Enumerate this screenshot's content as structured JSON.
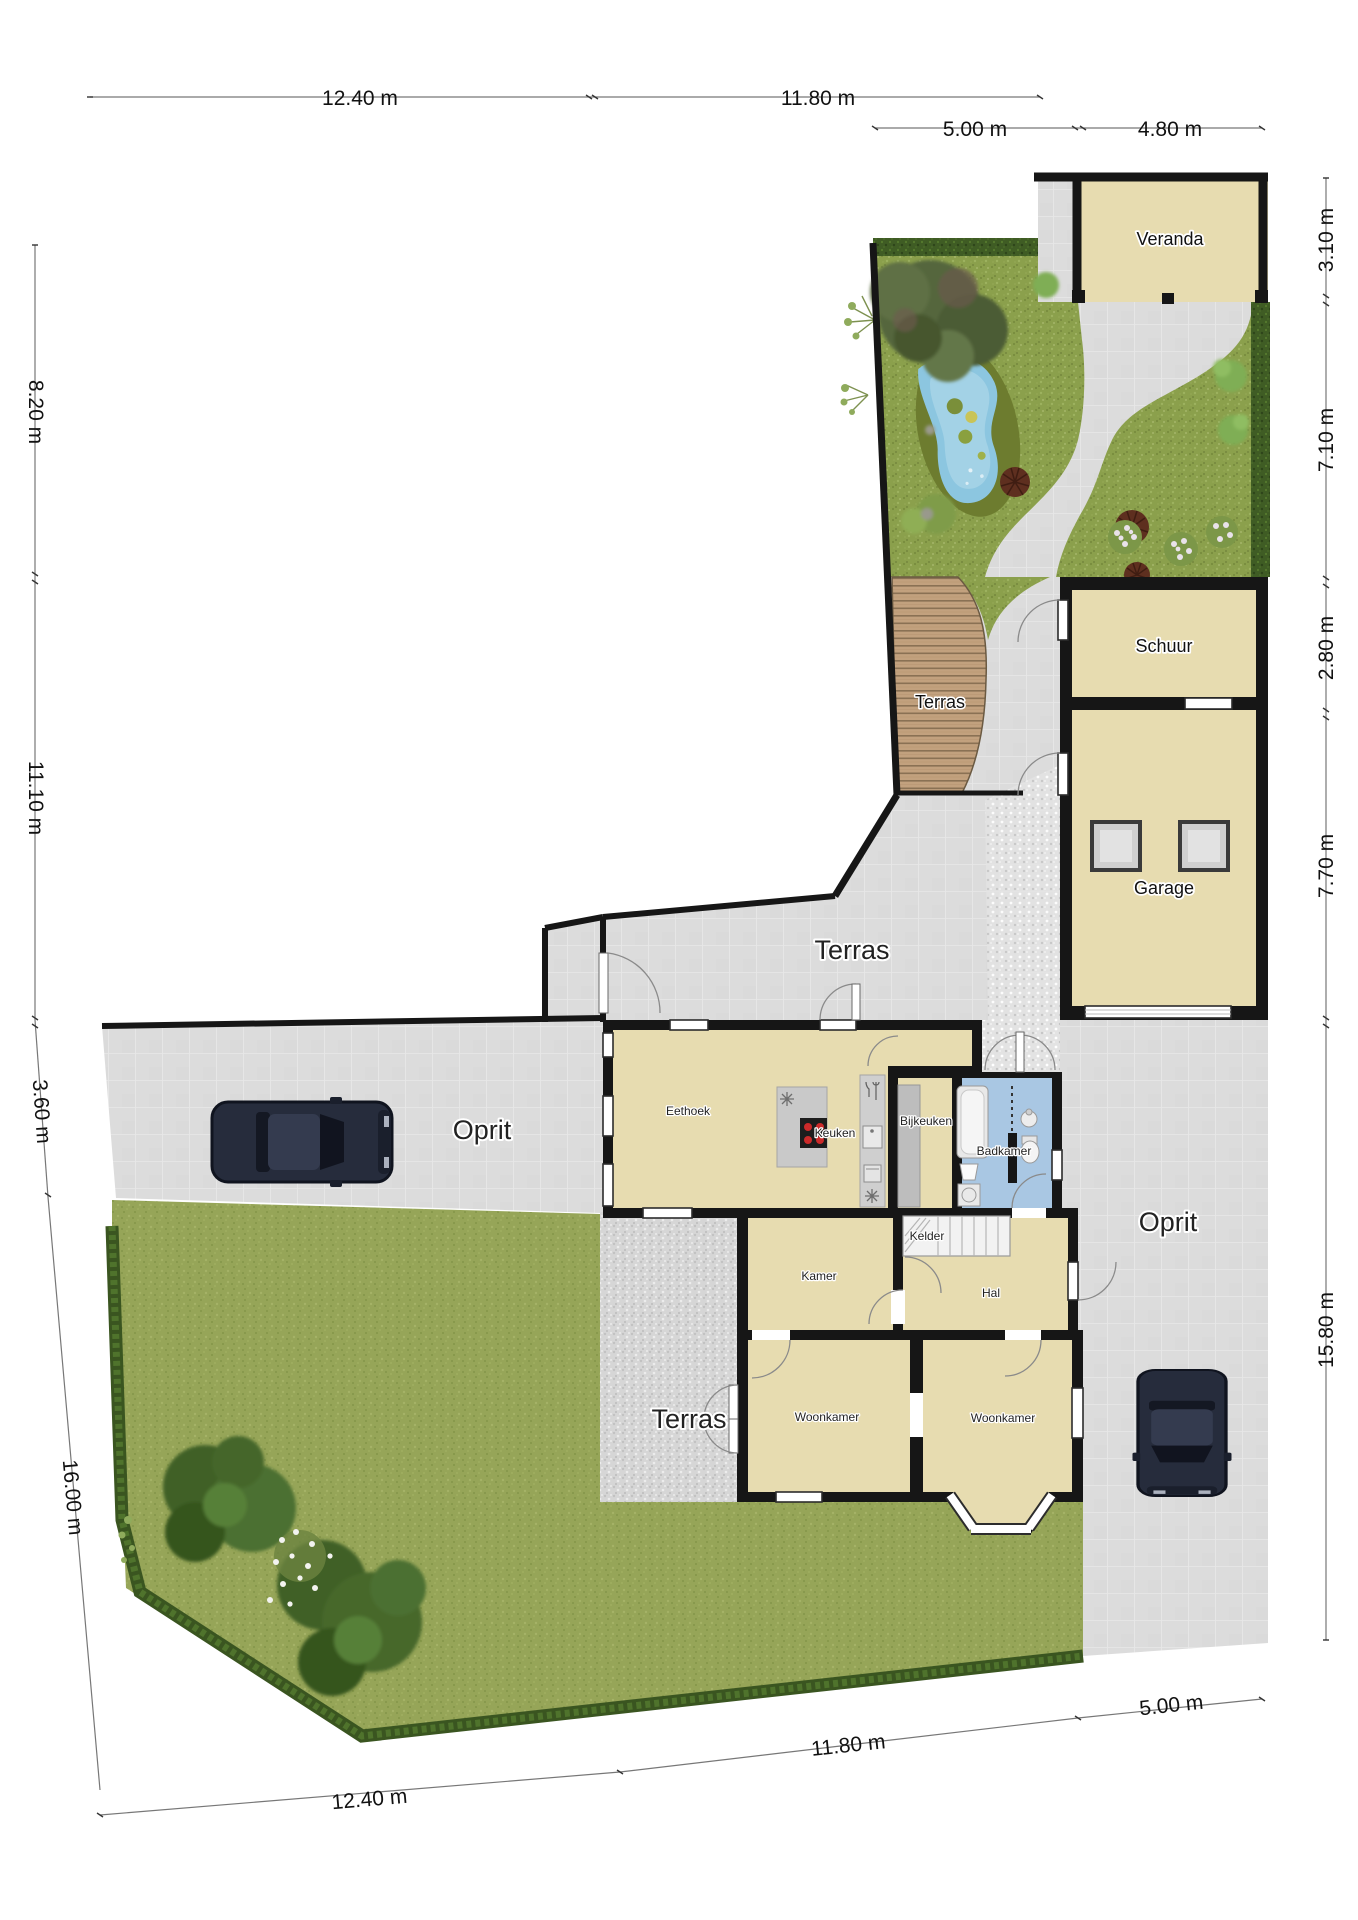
{
  "rooms": {
    "veranda": "Veranda",
    "schuur": "Schuur",
    "garage": "Garage",
    "eethoek": "Eethoek",
    "keuken": "Keuken",
    "bijkeuken": "Bijkeuken",
    "badkamer": "Badkamer",
    "kelder": "Kelder",
    "kamer": "Kamer",
    "hal": "Hal",
    "woonkamer_left": "Woonkamer",
    "woonkamer_right": "Woonkamer"
  },
  "areas": {
    "terras_garden_deck": "Terras",
    "terras_north": "Terras",
    "terras_south": "Terras",
    "oprit_west": "Oprit",
    "oprit_east": "Oprit"
  },
  "dimensions": {
    "top_row1": [
      "12.40 m",
      "11.80 m"
    ],
    "top_row2": [
      "5.00 m",
      "4.80 m"
    ],
    "right": [
      "3.10 m",
      "7.10 m",
      "2.80 m",
      "7.70 m",
      "15.80 m"
    ],
    "left": [
      "8.20 m",
      "11.10 m",
      "3.60 m",
      "16.00 m"
    ],
    "bottom": [
      "12.40 m",
      "11.80 m",
      "5.00 m"
    ]
  },
  "colors": {
    "room_fill": "#e7dcb0",
    "bathroom_fill": "#a9c7e3",
    "hardscape": "#dcdcdc",
    "wood_deck": "#c2a17e",
    "garden_grass": "#8ba04c",
    "lawn": "#96a558",
    "hedge": "#3f5c24",
    "pond_water": "#8cc6e0",
    "wall": "#161616",
    "dimension_text": "#1a1a1a"
  }
}
